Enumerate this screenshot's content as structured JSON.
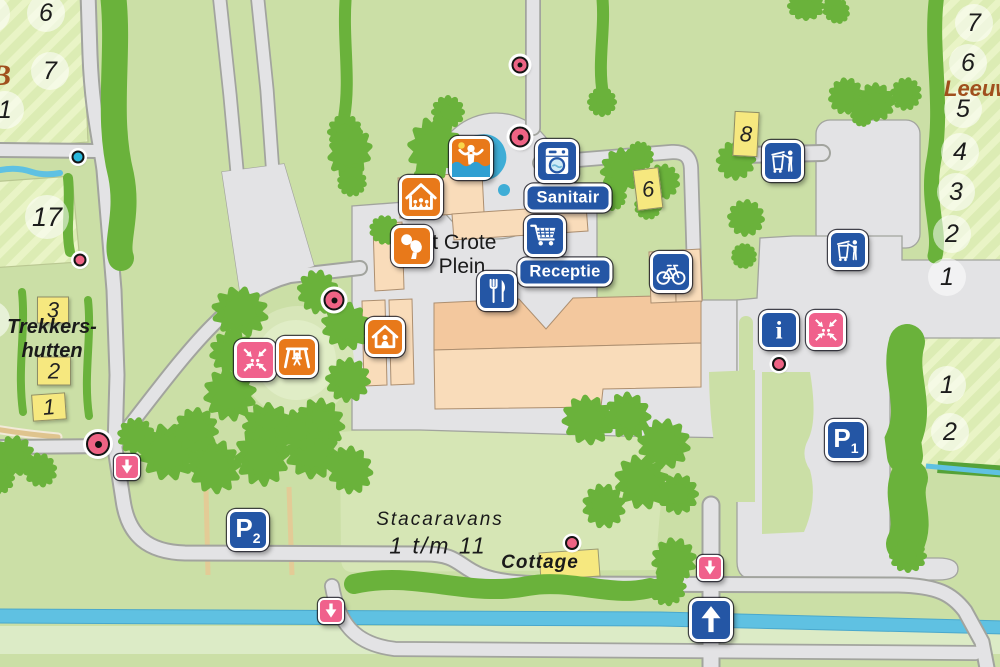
{
  "map_name": "campground-site-map",
  "colors": {
    "base_green": "#cbdfa6",
    "field_stripe": "#dcecb4",
    "tree_green": "#6ab23b",
    "road_gray": "#e3e3e5",
    "water_blue": "#5fc1e2",
    "building_peach": "#f9dcba",
    "building_roof": "#f3c89e",
    "yellow_building": "#f6e87f",
    "icon_blue": "#2456a5",
    "icon_orange": "#e8791a",
    "icon_pink": "#f0618c",
    "label_brown": "#a04f1d"
  },
  "badges": {
    "sanitair": "Sanitair",
    "receptie": "Receptie"
  },
  "labels": {
    "area_b_partial": "B",
    "leeuwerik_partial": "Leeuw",
    "trekkershutten_line1": "Trekkers-",
    "trekkershutten_line2": "hutten",
    "grote_plein_line1": "’t Grote",
    "grote_plein_line2": "Plein",
    "stacaravans_line1": "Stacaravans",
    "stacaravans_line2": "1 t/m 11",
    "cottage": "Cottage"
  },
  "pitch_circles": {
    "top_left": [
      "6",
      "7",
      "1",
      "17"
    ],
    "right_upper": [
      "7",
      "6",
      "5",
      "4",
      "3",
      "2",
      "1"
    ],
    "right_lower": [
      "1",
      "2"
    ]
  },
  "yellow_buildings": {
    "hut_3": "3",
    "hut_2": "2",
    "hut_1": "1",
    "building_8": "8",
    "building_6": "6"
  },
  "parking": {
    "p1_letter": "P",
    "p1_number": "1",
    "p2_letter": "P",
    "p2_number": "2"
  },
  "icons": {
    "swimming_pool_icon": "swimmer-with-ball",
    "laundry_icon": "washing-machine",
    "shopping_cart_icon": "shopping-cart",
    "restaurant_icon": "fork-and-knife",
    "bicycle_icon": "bicycle",
    "waste_disposal_icon": "person-at-waste-container",
    "info_icon": "letter-i",
    "meeting_point_icon": "arrows-to-center-with-people",
    "playground_icon": "swing-with-child",
    "indoor_play_icon": "house-with-children",
    "table_tennis_icon": "paddle-and-ball",
    "accommodation_icon": "house-with-person",
    "route_down_icon": "arrow-down",
    "route_up_icon": "arrow-up",
    "poi_marker": "pink-dot",
    "water_point_marker": "cyan-dot"
  }
}
